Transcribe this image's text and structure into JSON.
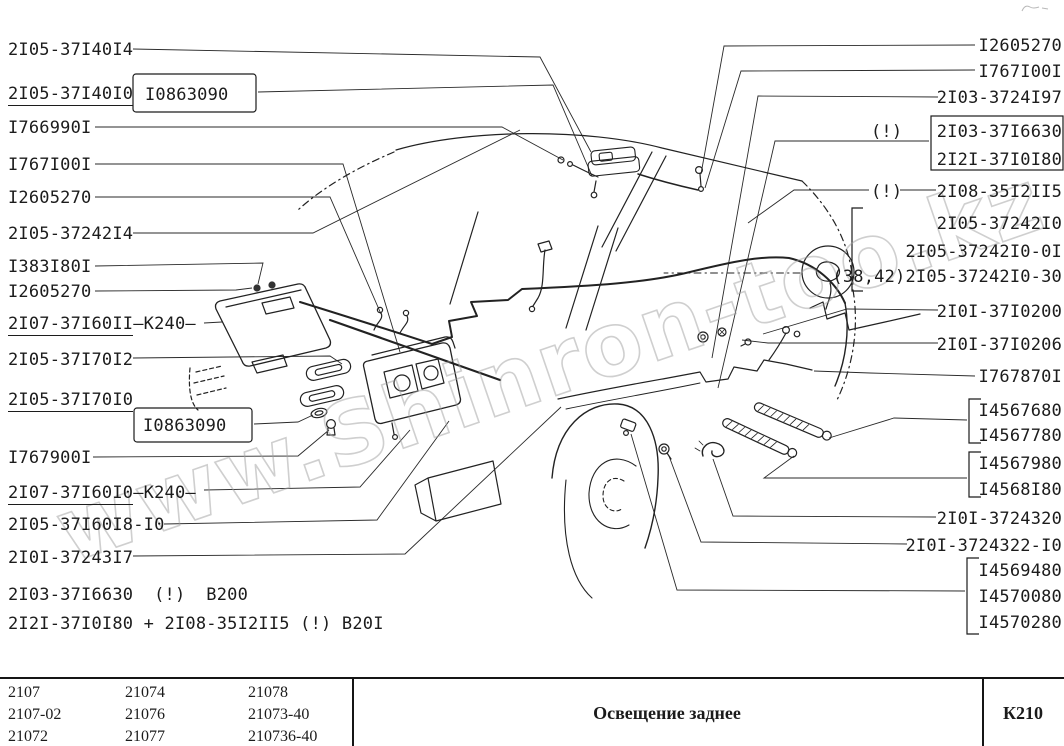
{
  "page": {
    "background": "#ffffff",
    "ink": "#1c1c1c",
    "leader_color": "#2a2a2a"
  },
  "watermark": {
    "text": "www.Shinron-too.kz"
  },
  "diagram": {
    "left_labels": [
      {
        "text": "2I05-37I40I4"
      },
      {
        "text": "2I05-37I40I0",
        "underline": true
      },
      {
        "text": "I0863090",
        "boxed": true
      },
      {
        "text": "I766990I"
      },
      {
        "text": "I767I00I"
      },
      {
        "text": "I2605270"
      },
      {
        "text": "2I05-37242I4"
      },
      {
        "text": "I383I80I"
      },
      {
        "text": "I2605270"
      },
      {
        "text": "2I07-37I60II",
        "underline": true,
        "suffix": "–К240–"
      },
      {
        "text": "2I05-37I70I2"
      },
      {
        "text": "2I05-37I70I0",
        "underline": true
      },
      {
        "text": "I0863090",
        "boxed": true
      },
      {
        "text": "I767900I"
      },
      {
        "text": "2I07-37I60I0",
        "underline": true,
        "suffix": "–К240–"
      },
      {
        "text": "2I05-37I60I8-I0"
      },
      {
        "text": "2I0I-37243I7"
      },
      {
        "text": "2I03-37I6630  (!)  B200"
      },
      {
        "text": "2I2I-37I0I80 + 2I08-35I2II5 (!) B20I"
      }
    ],
    "right_labels": [
      {
        "text": "I2605270"
      },
      {
        "text": "I767I00I"
      },
      {
        "text": "2I03-3724I97"
      },
      {
        "text": "(!)"
      },
      {
        "text": "2I03-37I6630",
        "boxed": true
      },
      {
        "text": "2I2I-37I0I80",
        "boxed": true
      },
      {
        "text": "(!)"
      },
      {
        "text": "2I08-35I2II5"
      },
      {
        "text": "2I05-37242I0"
      },
      {
        "text": "2I05-37242I0-0I"
      },
      {
        "text": "(38,42)2I05-37242I0-30"
      },
      {
        "text": "2I0I-37I0200"
      },
      {
        "text": "2I0I-37I0206"
      },
      {
        "text": "I767870I"
      },
      {
        "text": "I4567680",
        "bracketed": true
      },
      {
        "text": "I4567780",
        "bracketed": true
      },
      {
        "text": "I4567980",
        "bracketed": true
      },
      {
        "text": "I4568I80",
        "bracketed": true
      },
      {
        "text": "2I0I-3724320"
      },
      {
        "text": "2I0I-3724322-I0"
      },
      {
        "text": "I4569480",
        "bracketed": true
      },
      {
        "text": "I4570080",
        "bracketed": true
      },
      {
        "text": "I4570280",
        "bracketed": true
      }
    ]
  },
  "table": {
    "models": [
      [
        "2107",
        "2107-02",
        "21072"
      ],
      [
        "21074",
        "21076",
        "21077"
      ],
      [
        "21078",
        "21073-40",
        "210736-40"
      ]
    ],
    "title": "Освещение заднее",
    "sheet_code": "К210"
  }
}
